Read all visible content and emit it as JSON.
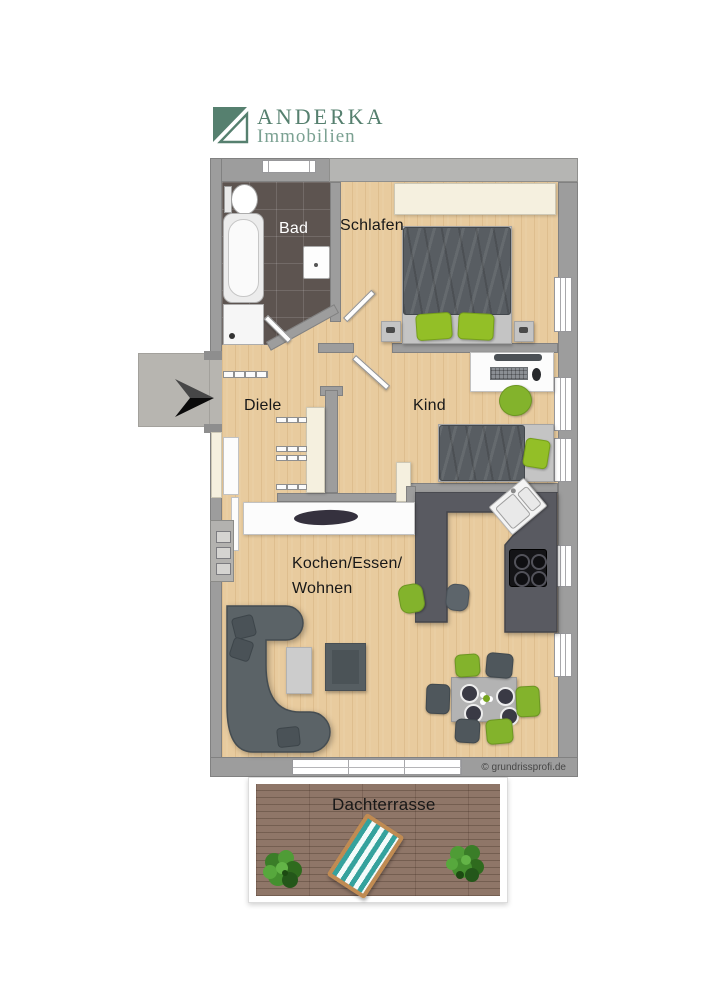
{
  "brand": {
    "title": "ANDERKA",
    "subtitle": "Immobilien",
    "logo_color": "#56806f",
    "logo_color_light": "#7ba192"
  },
  "rooms": {
    "bad": "Bad",
    "schlafen": "Schlafen",
    "diele": "Diele",
    "kind": "Kind",
    "wohnen_line1": "Kochen/Essen/",
    "wohnen_line2": "Wohnen",
    "terrasse": "Dachterrasse"
  },
  "watermark": "© grundrissprofi.de",
  "palette": {
    "wall_gray": "#9d9d9d",
    "wall_light": "#b5b5b3",
    "wood_floor": "#e8cb9e",
    "bath_tile": "#5d5450",
    "kitchen_counter": "#595a61",
    "terrace_deck": "#8f7668",
    "accent_green": "#8cba28",
    "furniture_gray": "#5b6367",
    "cream": "#f5f0df",
    "entry_landing": "#b7b5b0",
    "lounger_teal": "#35a29d"
  },
  "icons": {
    "entrance_arrow": "direction-arrow",
    "sun_lounger": "sun-lounger",
    "plant": "potted-plant",
    "copyright": "©"
  }
}
